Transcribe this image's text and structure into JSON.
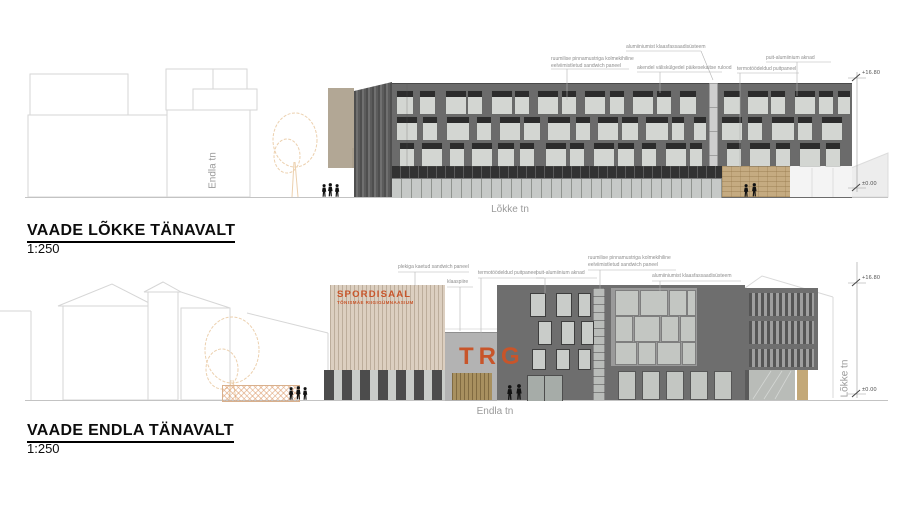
{
  "sheet": {
    "type": "architectural elevations",
    "colors": {
      "facade_gray": "#6b6b6b",
      "window_header_dark": "#2c2c2c",
      "window_pane_light": "#d3d6d2",
      "wood_light": "#dccfc0",
      "brick_tan": "#c5ab81",
      "entrance_wood": "#a8905f",
      "accent_orange": "#c8552a",
      "context_line": "#d6d6d6",
      "tree_sketch": "#ecd0ae"
    }
  },
  "elevations": {
    "lokke": {
      "title": "VAADE LÕKKE TÄNAVALT",
      "scale": "1:250",
      "street_label": "Lõkke tn",
      "cross_street_label": "Endla tn",
      "levels": {
        "top": "+16.80",
        "ground": "±0.00"
      },
      "annotations": [
        {
          "text": "ruumilise pinnamustriga kolmekihiline\neelviimistletud sandwich paneel"
        },
        {
          "text": "akendel väliskülgedel päikesekaitse rulood"
        },
        {
          "text": "alumiiniumist klaasfassaadisüsteem"
        },
        {
          "text": "termotöödeldud puitpaneel"
        },
        {
          "text": "puit-alumiinium aknad"
        }
      ]
    },
    "endla": {
      "title": "VAADE ENDLA TÄNAVALT",
      "scale": "1:250",
      "street_label": "Endla tn",
      "cross_street_label": "Lõkke tn",
      "levels": {
        "top": "+16.80",
        "ground": "±0.00"
      },
      "signage": {
        "sign_line1": "SPORDISAAL",
        "sign_line2": "TÕNISMÄE RIIGIGÜMNAASIUM",
        "logo": "TRG"
      },
      "annotations": [
        {
          "text": "plekiga kaetud sandwich paneel"
        },
        {
          "text": "klaaspiire"
        },
        {
          "text": "termotöödeldud puitpaneel"
        },
        {
          "text": "puit-alumiinium aknad"
        },
        {
          "text": "ruumilise pinnamustriga kolmekihiline\neelviimistletud sandwich paneel"
        },
        {
          "text": "alumiiniumist klaasfassaadisüsteem"
        }
      ]
    }
  }
}
